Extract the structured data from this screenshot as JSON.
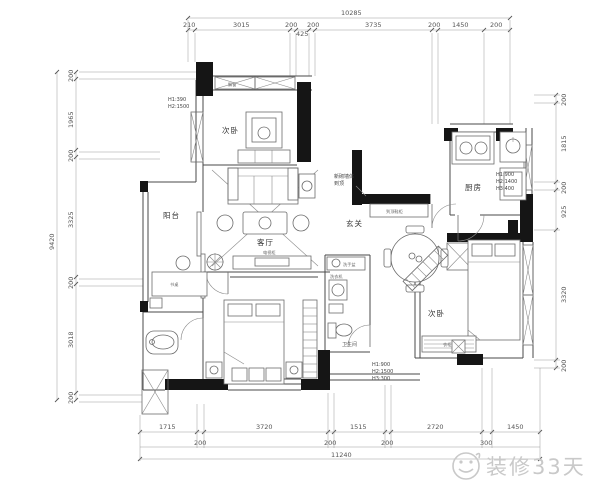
{
  "rooms": {
    "bedroom1": "次卧",
    "balcony": "阳台",
    "living": "客厅",
    "entry": "玄关",
    "kitchen": "厨房",
    "bedroom2": "次卧",
    "master": "主卧",
    "bathroom": "卫生间"
  },
  "furniture": {
    "shoe_cabinet": "到顶鞋柜",
    "tv_cabinet": "电视柜",
    "washer": "洗衣机",
    "basin": "洗手盆",
    "desk": "书桌",
    "wardrobe": "衣柜",
    "bay_window": "飘窗"
  },
  "notes": {
    "window_note": [
      "H1:390",
      "H2:1500"
    ],
    "kitchen_note": [
      "H1:900",
      "H2:1400",
      "H3:400"
    ],
    "bedroom2_note": [
      "H1:900",
      "H2:1500",
      "H3:300"
    ],
    "entry_note": [
      "新砌墙体",
      "到顶"
    ]
  },
  "dims": {
    "top": {
      "total": "10285",
      "segments": [
        "210",
        "3015",
        "200",
        "425",
        "200",
        "3735",
        "200",
        "1450",
        "200"
      ]
    },
    "left": {
      "total": "9420",
      "segments": [
        "200",
        "1965",
        "200",
        "3325",
        "200",
        "3018",
        "200"
      ]
    },
    "right": {
      "segments": [
        "200",
        "1815",
        "200",
        "925",
        "3320",
        "200"
      ]
    },
    "bottom": {
      "total": "11240",
      "main": [
        "1715",
        "3720",
        "1515",
        "2720",
        "1450"
      ],
      "small": [
        "200",
        "200",
        "200",
        "300"
      ]
    }
  },
  "watermark": {
    "brand": "装修33天"
  }
}
